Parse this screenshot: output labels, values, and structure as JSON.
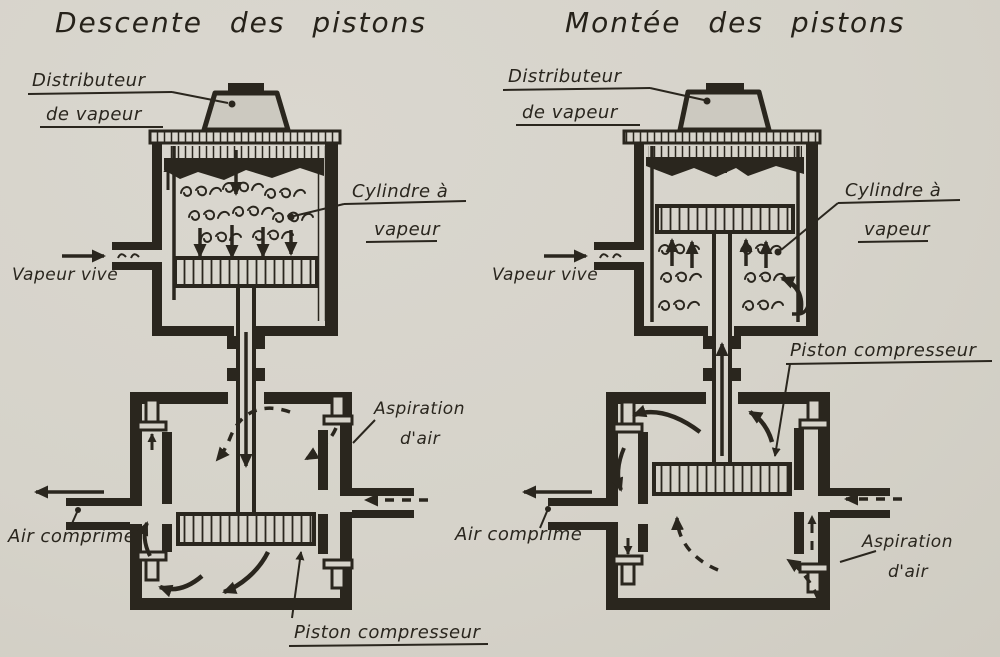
{
  "figure": {
    "name": "Compresseur d'air à vapeur — phases de fonctionnement",
    "colors": {
      "paper": "#d6d3ca",
      "ink": "#2a261e"
    }
  },
  "left": {
    "title": "Descente des pistons",
    "labels": {
      "distributeur_l1": "Distributeur",
      "distributeur_l2": "de vapeur",
      "cylindre_l1": "Cylindre à",
      "cylindre_l2": "vapeur",
      "vapeur_vive": "Vapeur vive",
      "aspiration_l1": "Aspiration",
      "aspiration_l2": "d'air",
      "air_comprime": "Air comprimé",
      "piston_compresseur": "Piston compresseur"
    }
  },
  "right": {
    "title": "Montée des pistons",
    "labels": {
      "distributeur_l1": "Distributeur",
      "distributeur_l2": "de vapeur",
      "cylindre_l1": "Cylindre à",
      "cylindre_l2": "vapeur",
      "vapeur_vive": "Vapeur vive",
      "aspiration_l1": "Aspiration",
      "aspiration_l2": "d'air",
      "air_comprime": "Air comprimé",
      "piston_compresseur": "Piston compresseur"
    }
  }
}
